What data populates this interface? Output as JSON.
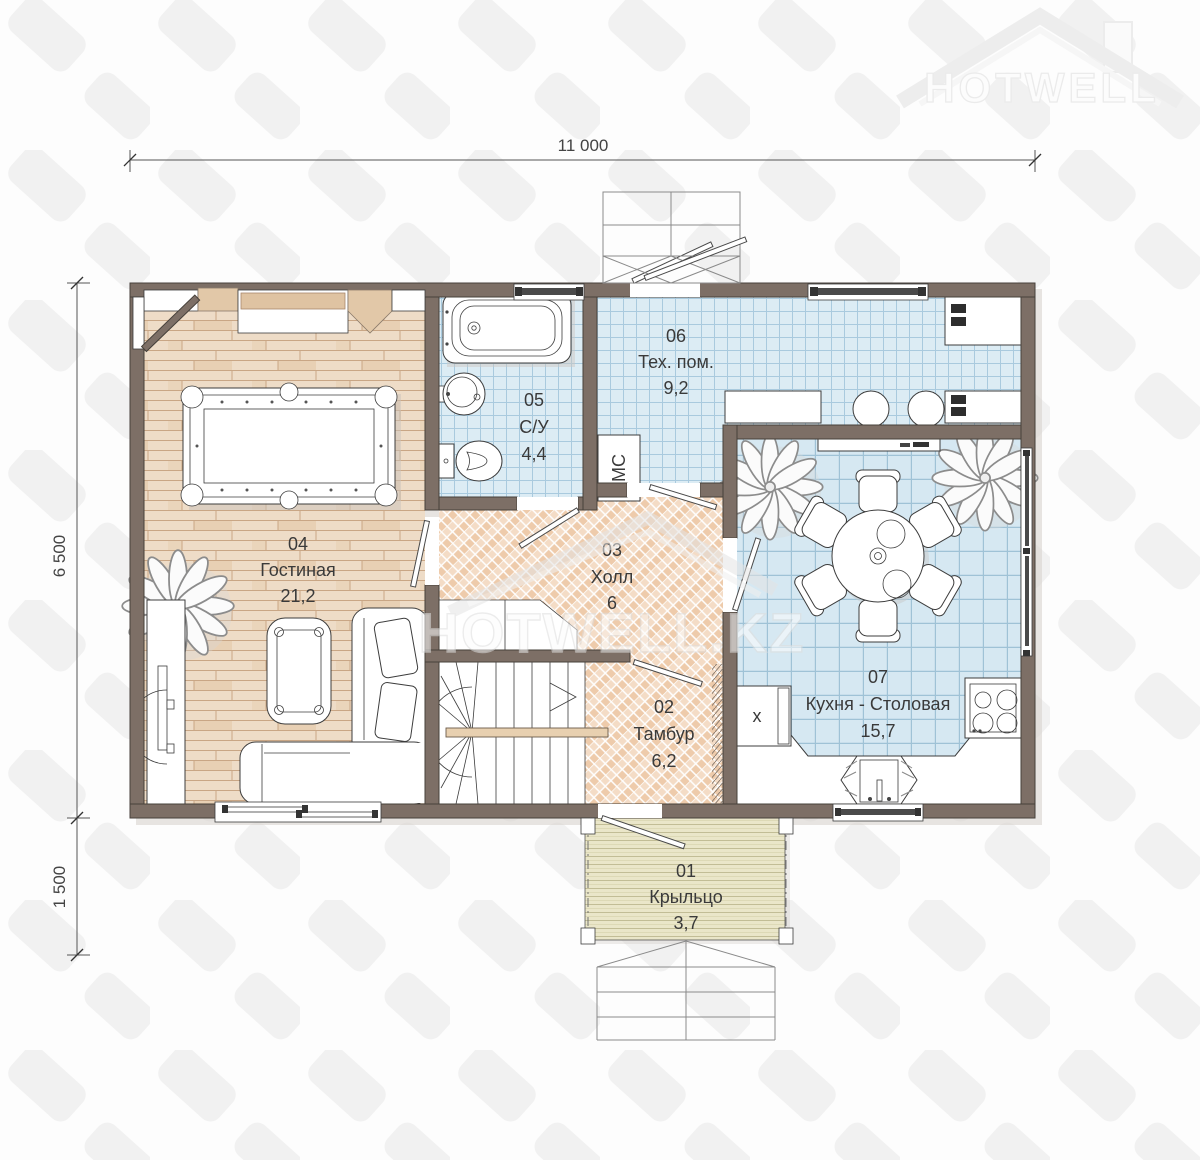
{
  "watermark": {
    "brand": "HOTWELL.KZ",
    "logo_text": "HOTWELL"
  },
  "dimensions": {
    "width_total": "11 000",
    "depth_main": "6 500",
    "depth_porch": "1 500"
  },
  "rooms": {
    "r01": {
      "number": "01",
      "name": "Крыльцо",
      "area": "3,7"
    },
    "r02": {
      "number": "02",
      "name": "Тамбур",
      "area": "6,2"
    },
    "r03": {
      "number": "03",
      "name": "Холл",
      "area": "6"
    },
    "r04": {
      "number": "04",
      "name": "Гостиная",
      "area": "21,2"
    },
    "r05": {
      "number": "05",
      "name": "С/У",
      "area": "4,4"
    },
    "r06": {
      "number": "06",
      "name": "Тех. пом.",
      "area": "9,2"
    },
    "r07": {
      "number": "07",
      "name": "Кухня - Столовая",
      "area": "15,7"
    }
  },
  "equipment": {
    "washing_machine": "МС",
    "fridge_mark": "x"
  },
  "colors": {
    "wall": "#7d6f66",
    "wood_floor": "#eedcc7",
    "parquet": "#eecbab",
    "tile_bath": "#dcecf4",
    "tile_kitchen": "#d6e8f2",
    "deck": "#eae6c9",
    "sill_accent": "#dfc3a2"
  }
}
